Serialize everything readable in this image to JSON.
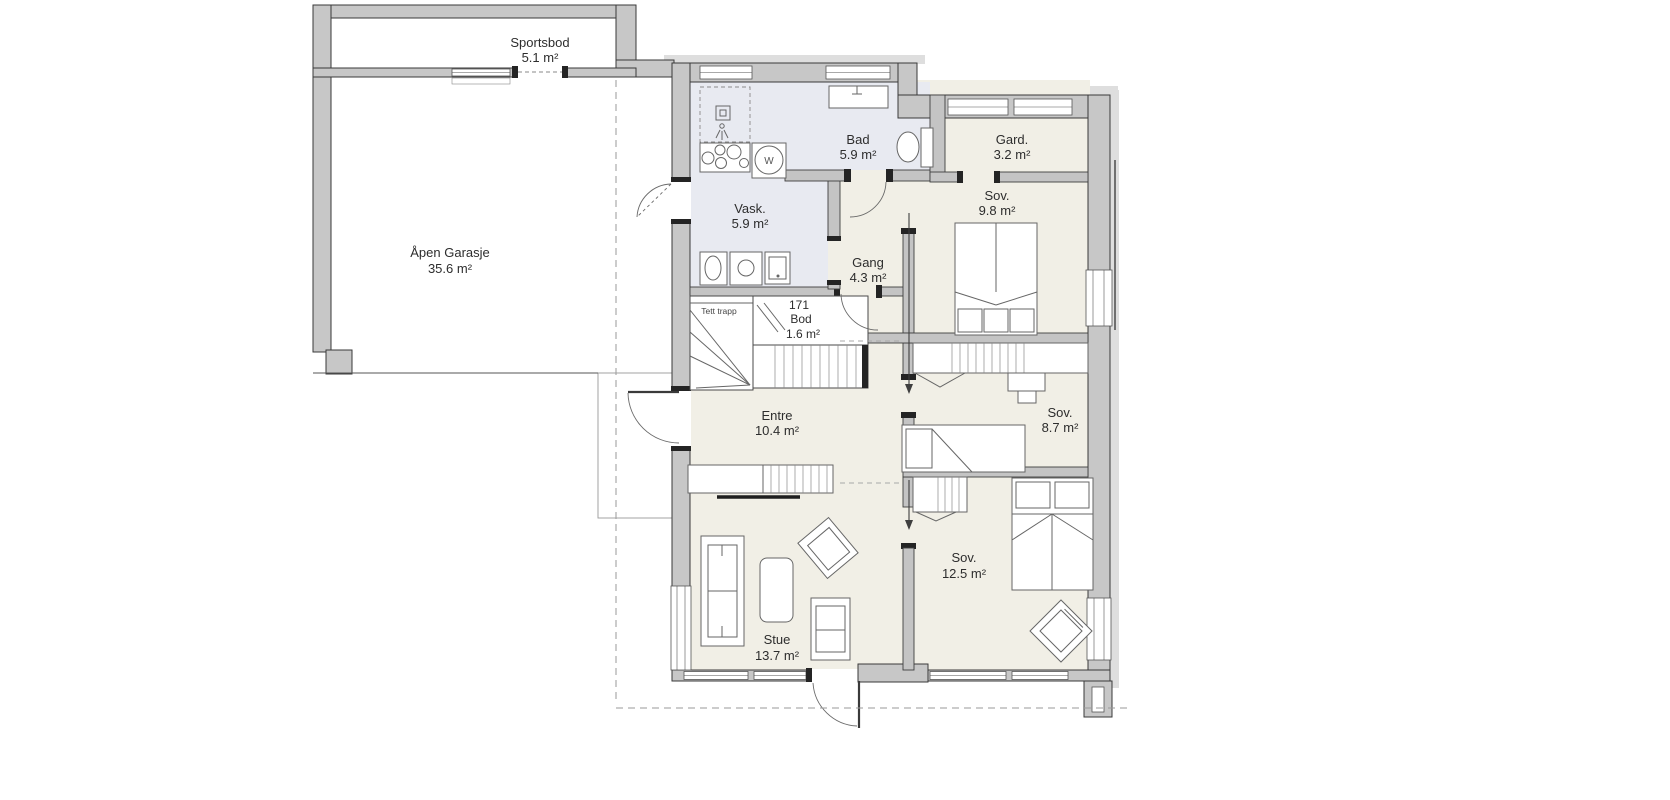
{
  "plan": {
    "title": "First floor plan",
    "rooms": [
      {
        "name": "Sportsbod",
        "area": "5.1 m²"
      },
      {
        "name": "Åpen Garasje",
        "area": "35.6 m²"
      },
      {
        "name": "Vask.",
        "area": "5.9 m²"
      },
      {
        "name": "Bad",
        "area": "5.9 m²"
      },
      {
        "name": "Gard.",
        "area": "3.2 m²"
      },
      {
        "name": "Sov.",
        "area": "9.8 m²"
      },
      {
        "name": "Gang",
        "area": "4.3 m²"
      },
      {
        "number": "171",
        "name": "Bod",
        "area": "1.6 m²"
      },
      {
        "name": "Entre",
        "area": "10.4 m²"
      },
      {
        "name": "Sov.",
        "area": "8.7 m²"
      },
      {
        "name": "Sov.",
        "area": "12.5 m²"
      },
      {
        "name": "Stue",
        "area": "13.7 m²"
      }
    ],
    "annotations": {
      "stairs": "Tett trapp",
      "washer_letter": "W"
    },
    "colors": {
      "wall_fill": "#c7c7c7",
      "wall_edge": "#3a3a3a",
      "floor_main": "#f1efe6",
      "floor_wet": "#e8eaf1",
      "eave": "#dedede",
      "dashed_line": "#9a9a9a"
    }
  }
}
